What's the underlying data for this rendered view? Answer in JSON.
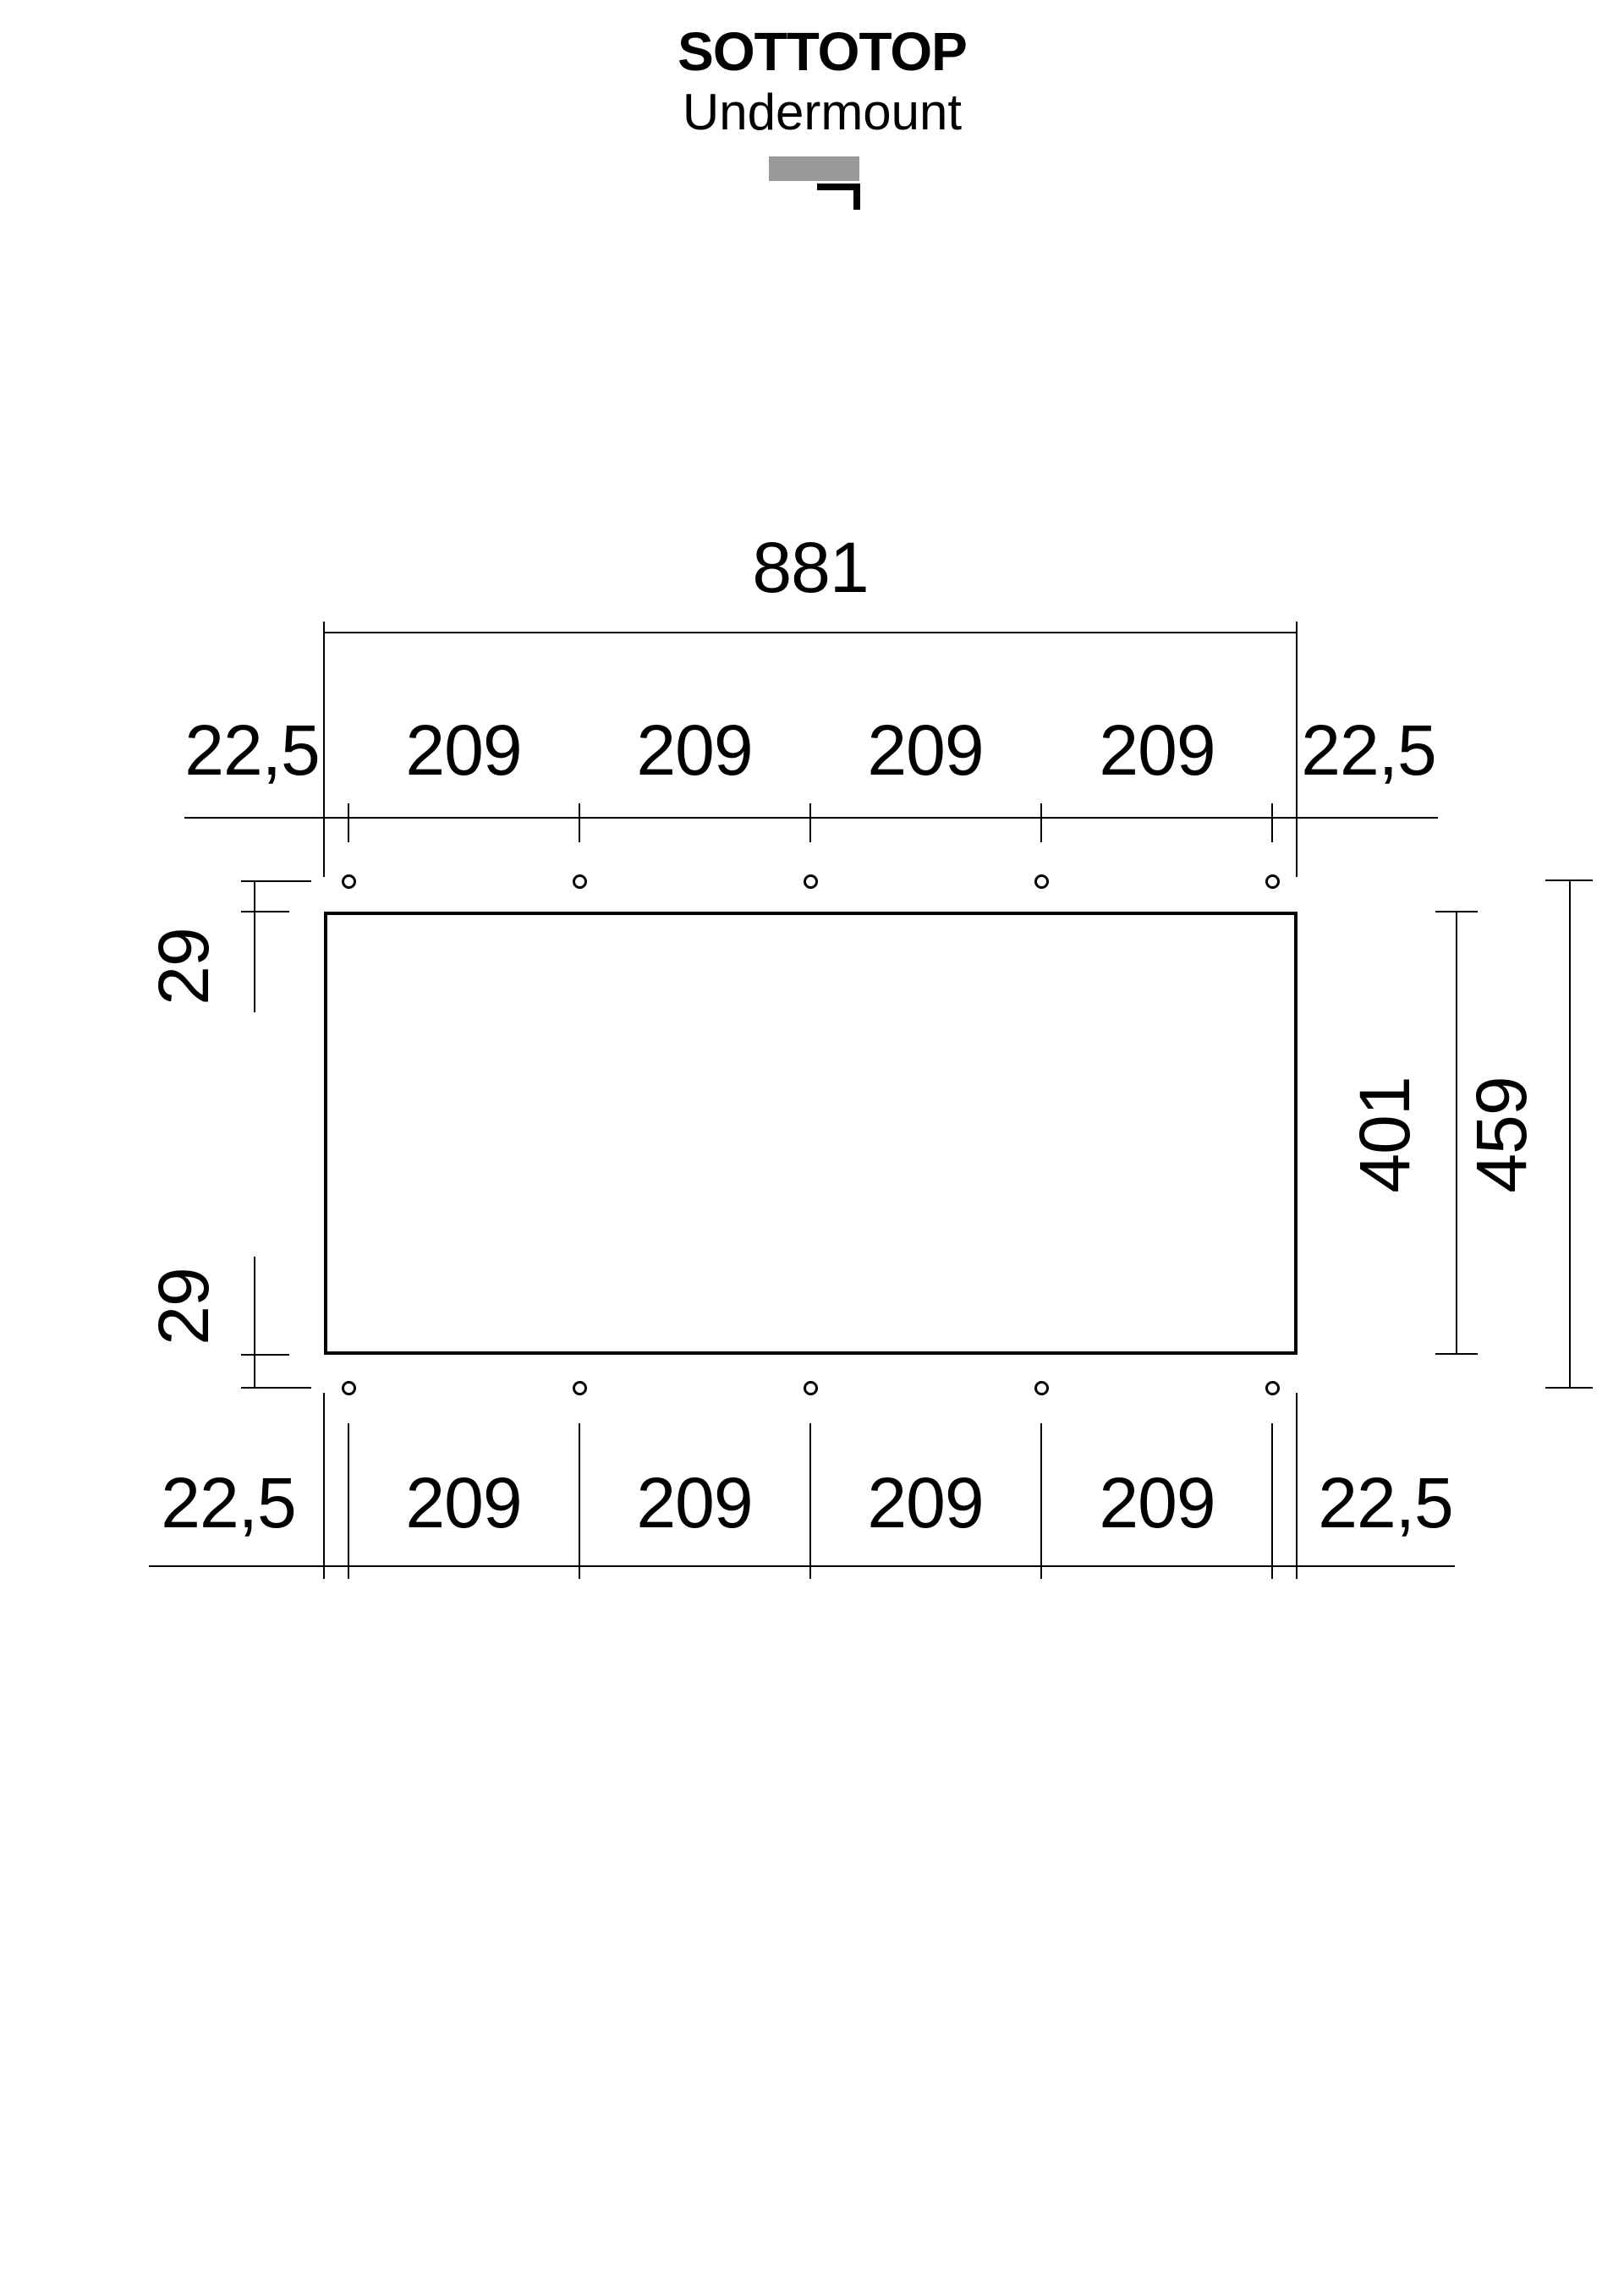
{
  "header": {
    "title": "SOTTOTOP",
    "subtitle": "Undermount"
  },
  "legend_icon": {
    "name": "undermount-installation-icon",
    "countertop_color": "#999999",
    "sink_rim_color": "#000000"
  },
  "dimensions": {
    "overall_width": "881",
    "top_row": [
      "22,5",
      "209",
      "209",
      "209",
      "209",
      "22,5"
    ],
    "bottom_row": [
      "22,5",
      "209",
      "209",
      "209",
      "209",
      "22,5"
    ],
    "left_top_offset": "29",
    "left_bottom_offset": "29",
    "cutout_height": "401",
    "hole_row_span": "459"
  },
  "drawing": {
    "hole_count": 10,
    "line_color": "#000000",
    "background_color": "#ffffff"
  }
}
